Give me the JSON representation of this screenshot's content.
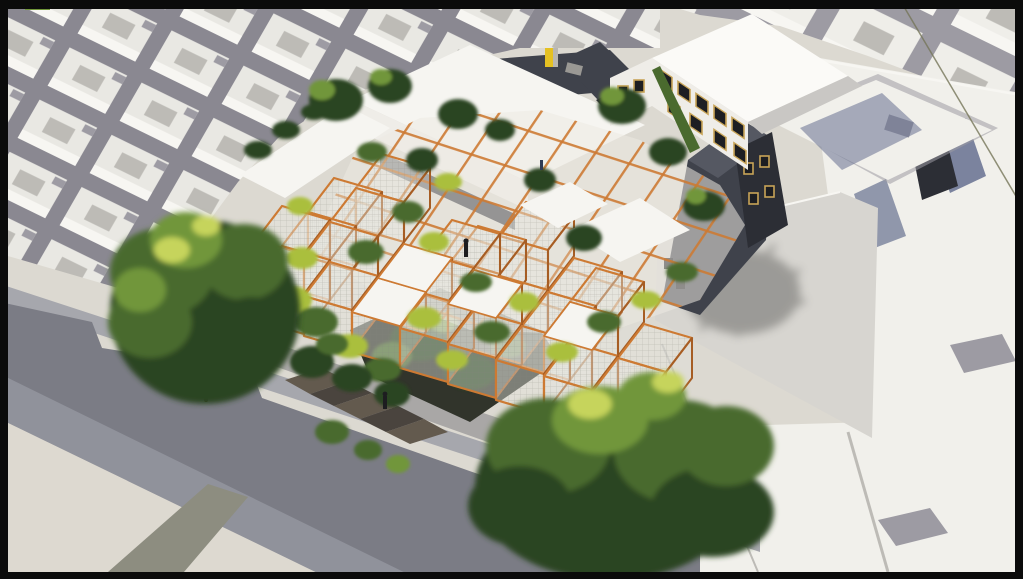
{
  "meta": {
    "type": "architectural-aerial-render",
    "description": "Aerial 3D rendering of an orange modular lattice building overgrown with green and yellow plants, set within a white city massing model with shaded streets, large trees and bright white neighboring blocks"
  },
  "colors": {
    "frame": "#0b0b0b",
    "base": "#dcd9d1",
    "block": "#e9e8e3",
    "block_lit": "#f7f6f2",
    "gap": "#8a8891",
    "block_b": "#efeee9",
    "gap_b": "#9d9ba3",
    "notch": "#bdbbb6",
    "white_field": "#f1f0eb",
    "street": "#7b7c85",
    "street_lit": "#a6a7ad",
    "street_band": "#90929b",
    "plaza": "#ddd9d0",
    "stripe": "#8d8d80",
    "orange": "#cd7a33",
    "orange_dark": "#a65d24",
    "mesh": "#e6e5de",
    "slab": "#f6f5f1",
    "wall": "#efede8",
    "dark": "#3f424b",
    "dark2": "#2c2e35",
    "glass": "#1d1e22",
    "win_frame": "#c8a457",
    "roof_grey": "#d7d5d0",
    "shadow_blue": "#667090",
    "green_dark": "#2c4423",
    "green_mid": "#4a6a2e",
    "green_light": "#71963a",
    "green_yellow": "#aabf3e",
    "green_hi": "#c6d45c",
    "trunk": "#3a2d1f",
    "court": "#31342b",
    "planter": "#635a4e",
    "planter_top": "#4a443e",
    "yellow": "#e5c122",
    "wire": "#767659"
  },
  "scene": {
    "hero": "orange-lattice-garden-building",
    "context": "white-city-massing-model",
    "features": [
      "shaded-street",
      "plaza-planters",
      "large-tree-left",
      "large-tree-bottom",
      "windowed-neighbor-building",
      "grey-roof-with-tree-shadow",
      "rooftop-stair-bulkhead-yellow"
    ]
  }
}
